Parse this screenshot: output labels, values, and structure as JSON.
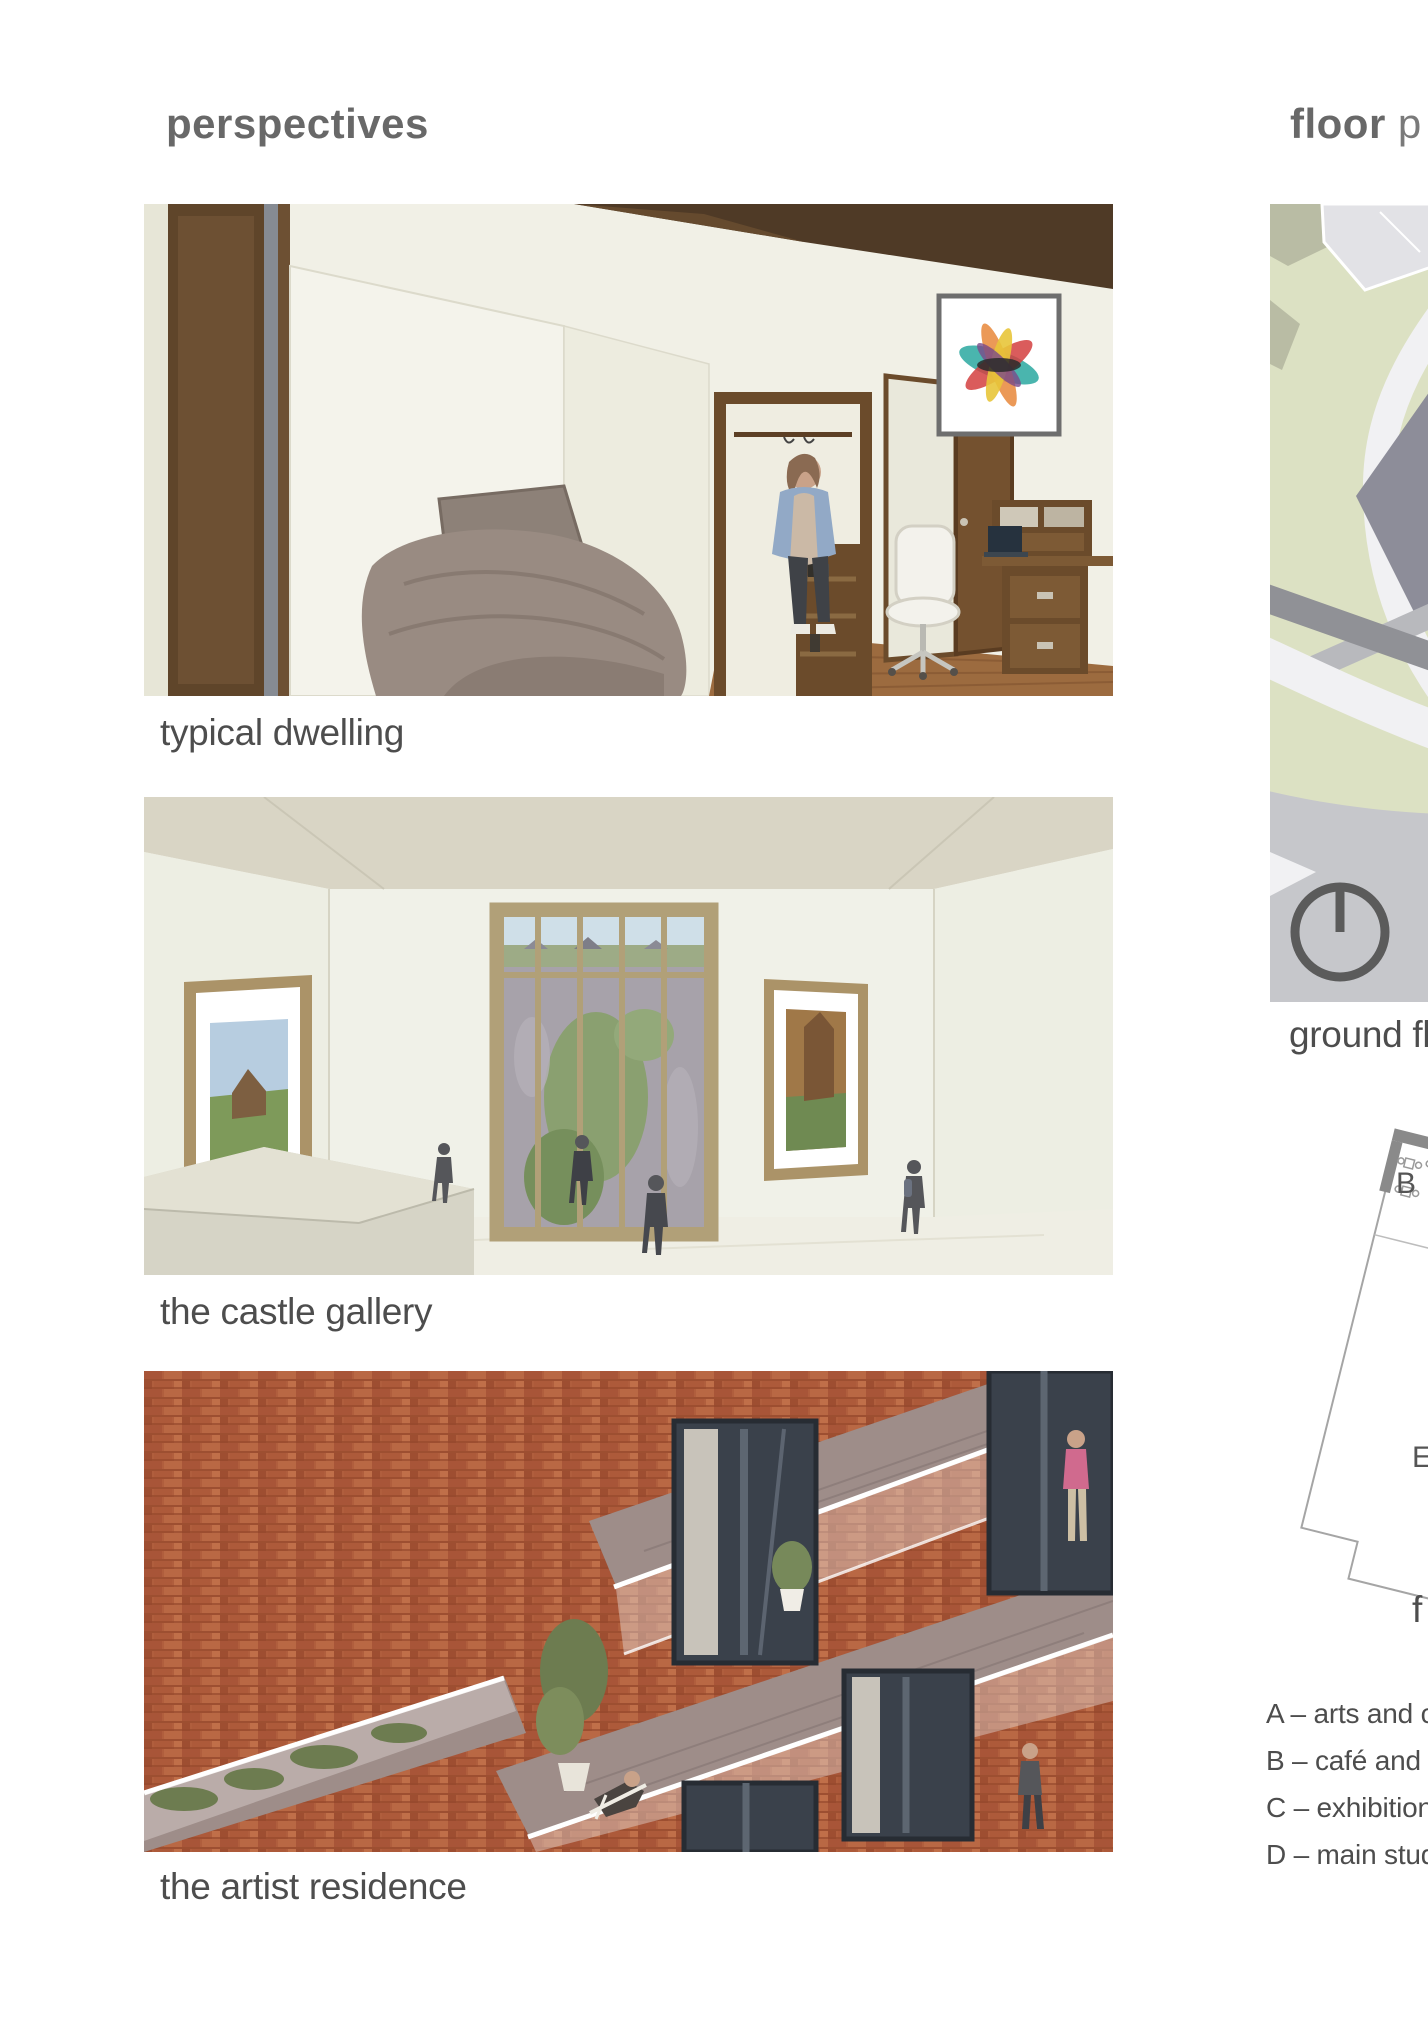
{
  "left_column": {
    "heading": "perspectives",
    "figures": [
      {
        "caption": "typical dwelling"
      },
      {
        "caption": "the castle gallery"
      },
      {
        "caption": "the artist residence"
      }
    ]
  },
  "right_column": {
    "heading_bold": "floor",
    "heading_rest": "p",
    "ground_floor": {
      "caption": "ground fl"
    },
    "upper_floor": {
      "caption": "f",
      "plan_labels": {
        "b": "B",
        "e": "E"
      }
    },
    "legend": [
      "A – arts and cr",
      "B – café and re",
      "C – exhibition s",
      "D – main studi"
    ]
  },
  "icons": {
    "north_arrow": "north-arrow-icon"
  },
  "colors": {
    "heading_gray": "#686868",
    "caption_gray": "#4d4d4d",
    "site_green": "#dce1c3",
    "site_olive": "#b6b9a0",
    "site_plaza_gray": "#c6c7cb",
    "site_road_gray": "#909196",
    "site_building_gray": "#8d8d99",
    "context_building_gray": "#e2e2e6",
    "plan_line_gray": "#a5a5a5",
    "plan_wall_gray": "#8a8a8a",
    "brick_red": "#ae5c3c",
    "terrace_mauve": "#9e8d89",
    "render_wall_cream": "#f1f0e6",
    "gallery_ceiling_beige": "#d9d5c5",
    "wood_brown": "#5f452a"
  }
}
